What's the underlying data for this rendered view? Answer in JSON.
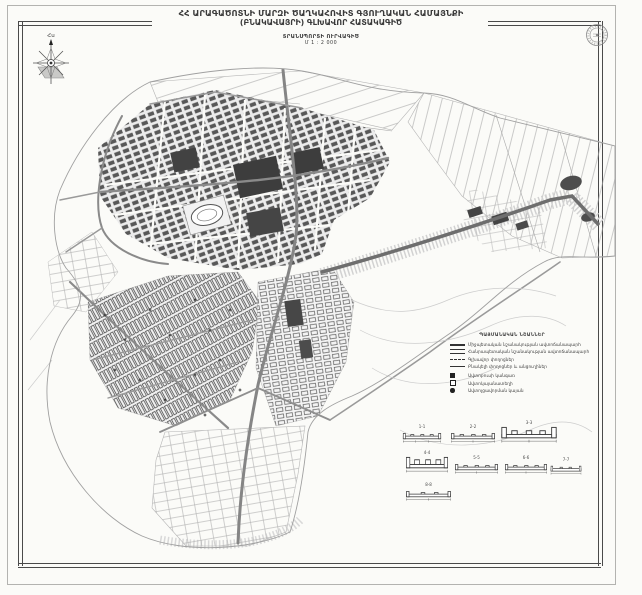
{
  "header": {
    "title_line1": "ՀՀ ԱՐԱԳԱԾՈՏՆԻ ՄԱՐԶԻ ԾԱՂԿԱՀՈՎԻՏ ԳՅՈՒՂԱԿԱՆ ՀԱՄԱՅՆՔԻ",
    "title_line2": "(ԲՆԱԿԱՎԱՅՐԻ) ԳԼԽԱՎՈՐ ՀԱՏԱԿԱԳԻԾ",
    "subtitle": "ՏՐԱՆՍՊՈՐՏԻ ՈՒՐՎԱԳԻԾ",
    "scale": "Մ 1 : 2 000"
  },
  "compass": {
    "north_label": "Հս"
  },
  "legend": {
    "title": "ՊԱՅՄԱՆԱԿԱՆ ՆՇԱՆՆԵՐ",
    "line_items": [
      {
        "label": "Միջպետական նշանակության ավտոճանապարհ"
      },
      {
        "label": "Հանրապետական նշանակության ավտոճանապարհ"
      },
      {
        "label": "Գլխավոր փողոցներ"
      },
      {
        "label": "Բնակելի փողոցներ և անցուղիներ"
      }
    ],
    "point_items": [
      {
        "label": "Ավտոբուսի կանգառ"
      },
      {
        "label": "Ավտոկայանատեղի"
      },
      {
        "label": "Ավտոլցավորման կայան"
      }
    ]
  },
  "sections": {
    "items": [
      {
        "label": "1-1"
      },
      {
        "label": "2-2"
      },
      {
        "label": "3-3"
      },
      {
        "label": "4-4"
      },
      {
        "label": "5-5"
      },
      {
        "label": "6-6"
      },
      {
        "label": "7-7"
      },
      {
        "label": "8-8"
      }
    ]
  },
  "colors": {
    "ink": "#3a3a3a",
    "paper": "#fbfbf8",
    "frame": "#4a4a4a"
  }
}
